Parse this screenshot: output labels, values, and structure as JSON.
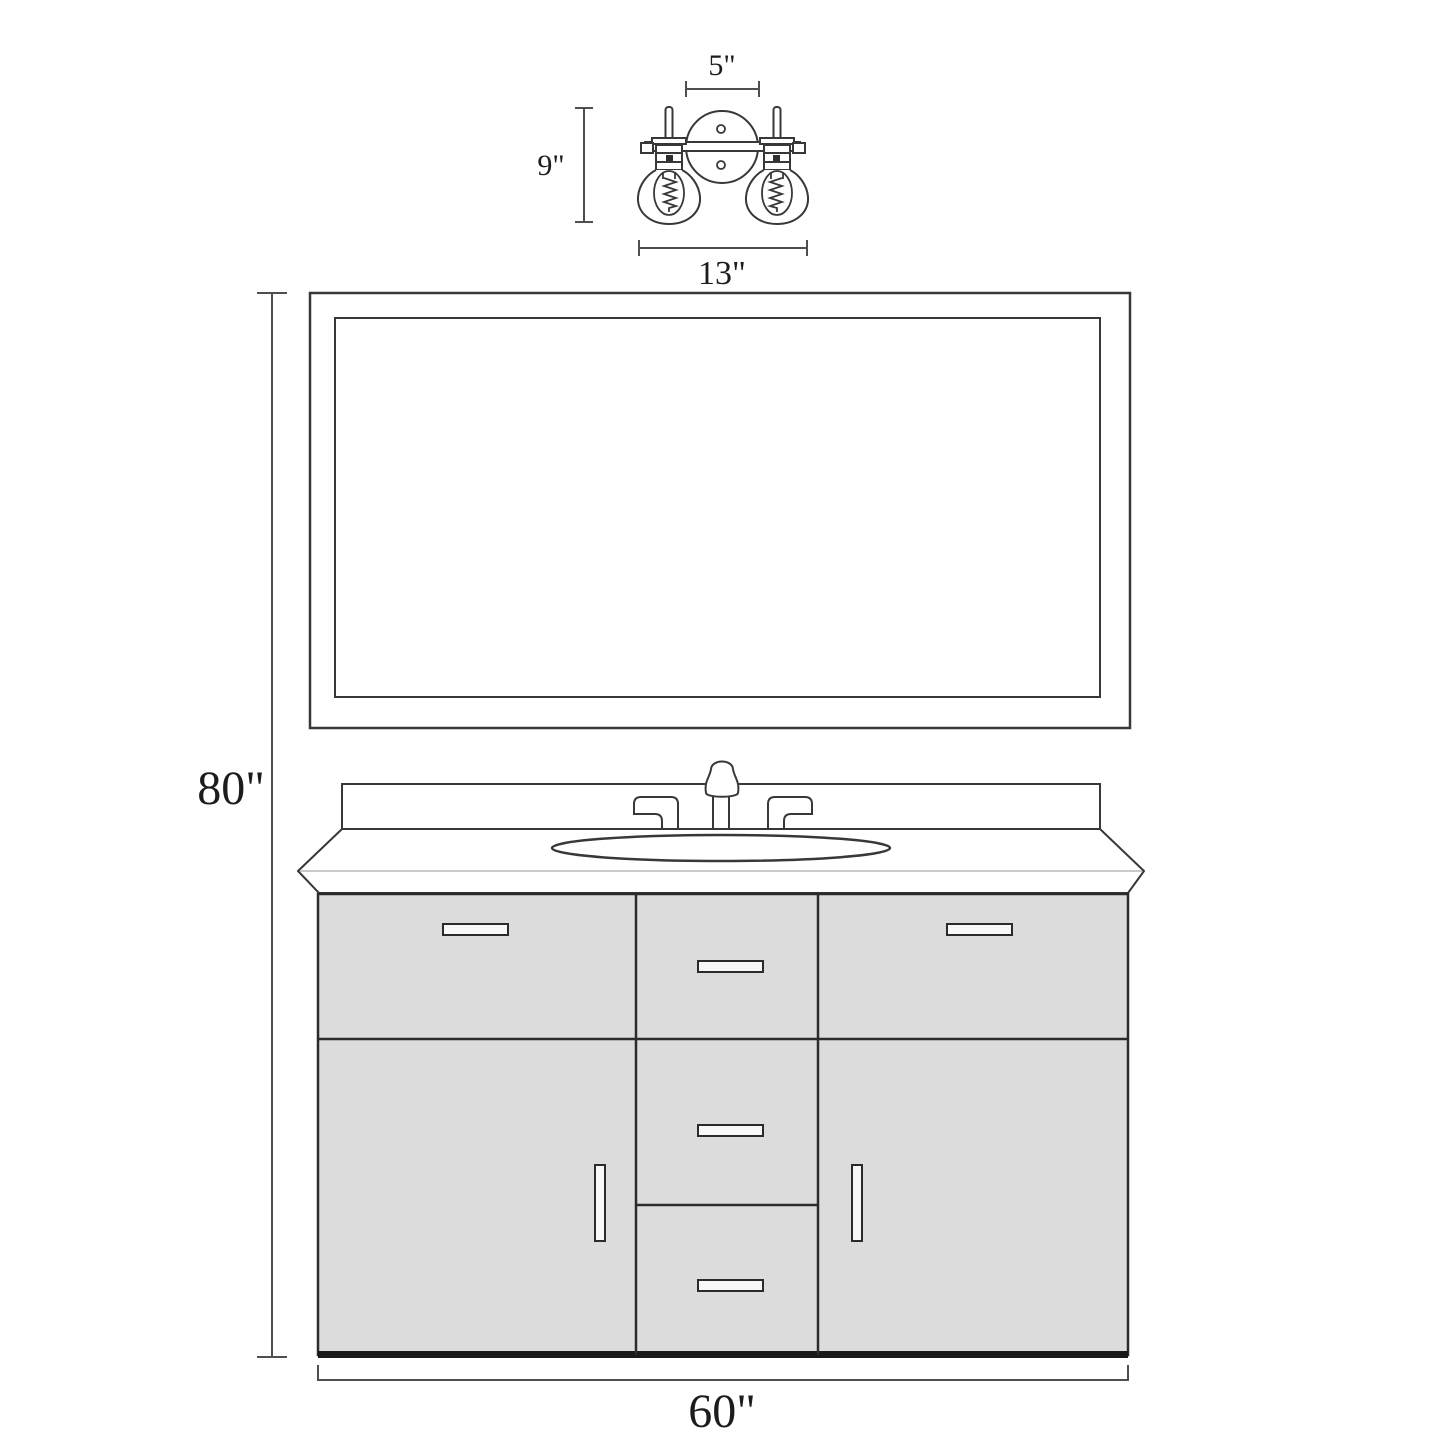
{
  "diagram": {
    "type": "technical-dimension-line-drawing",
    "subject": "bathroom vanity set: 2-light wall sconce, framed rectangular mirror, single-sink vanity cabinet",
    "colors": {
      "background": "#ffffff",
      "line": "#383838",
      "cabinet_fill": "#dcdcdc",
      "handle_fill": "#f8f8f8",
      "dimension_line": "#4f4f4f",
      "label_text": "#1c1c1c",
      "counter_front_edge": "#b8b8b8",
      "base_strip": "#191919"
    },
    "dimensions": {
      "sconce_backplate_width": "5\"",
      "sconce_height": "9\"",
      "sconce_width": "13\"",
      "overall_height": "80\"",
      "vanity_width": "60\""
    },
    "components": {
      "light_fixture": "double glass-globe sconce with Edison bulbs on round backplate",
      "mirror": "double-framed rectangular mirror",
      "vanity": "six-front cabinet: 2 top drawer fronts, 3 center drawers, 2 doors, oval sink, 3-hole faucet"
    }
  }
}
